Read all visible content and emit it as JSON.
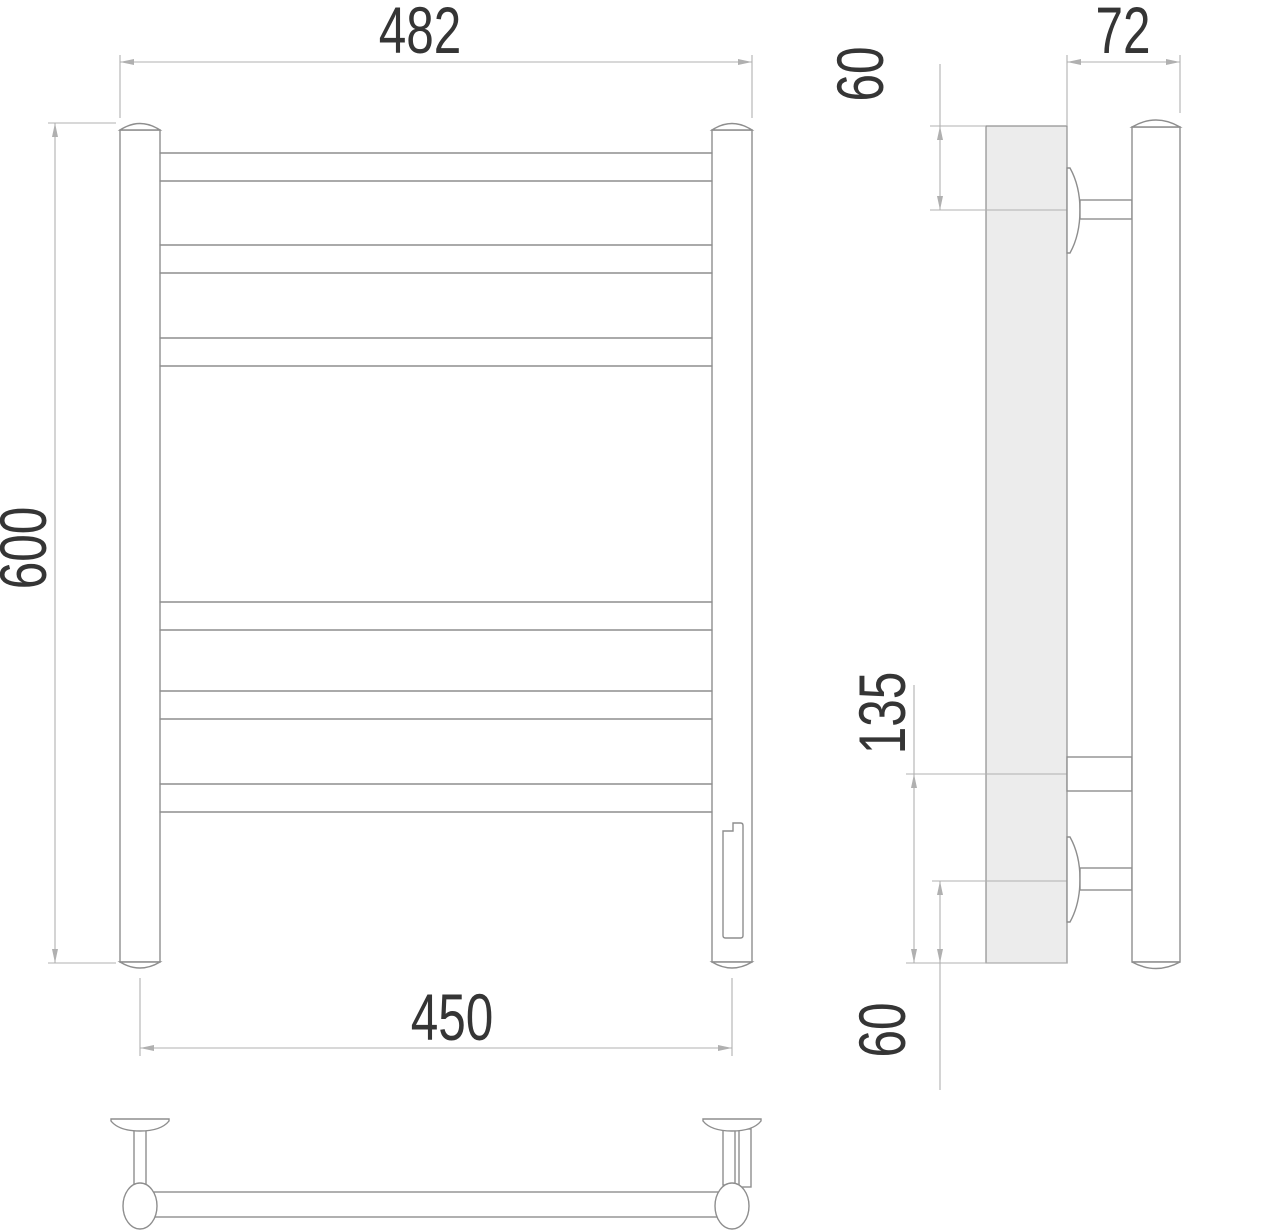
{
  "colors": {
    "object_line": "#8e8e8e",
    "dimension_line": "#b0b0b0",
    "label_text": "#353535",
    "wall_fill": "#ececec",
    "background": "#ffffff"
  },
  "dimensions": {
    "front_view": {
      "overall_width": "482",
      "overall_height": "600",
      "mount_spacing": "450"
    },
    "side_view": {
      "overall_depth": "72",
      "top_bracket_offset": "60",
      "lower_element_offset": "135",
      "bottom_bracket_offset": "60"
    }
  }
}
